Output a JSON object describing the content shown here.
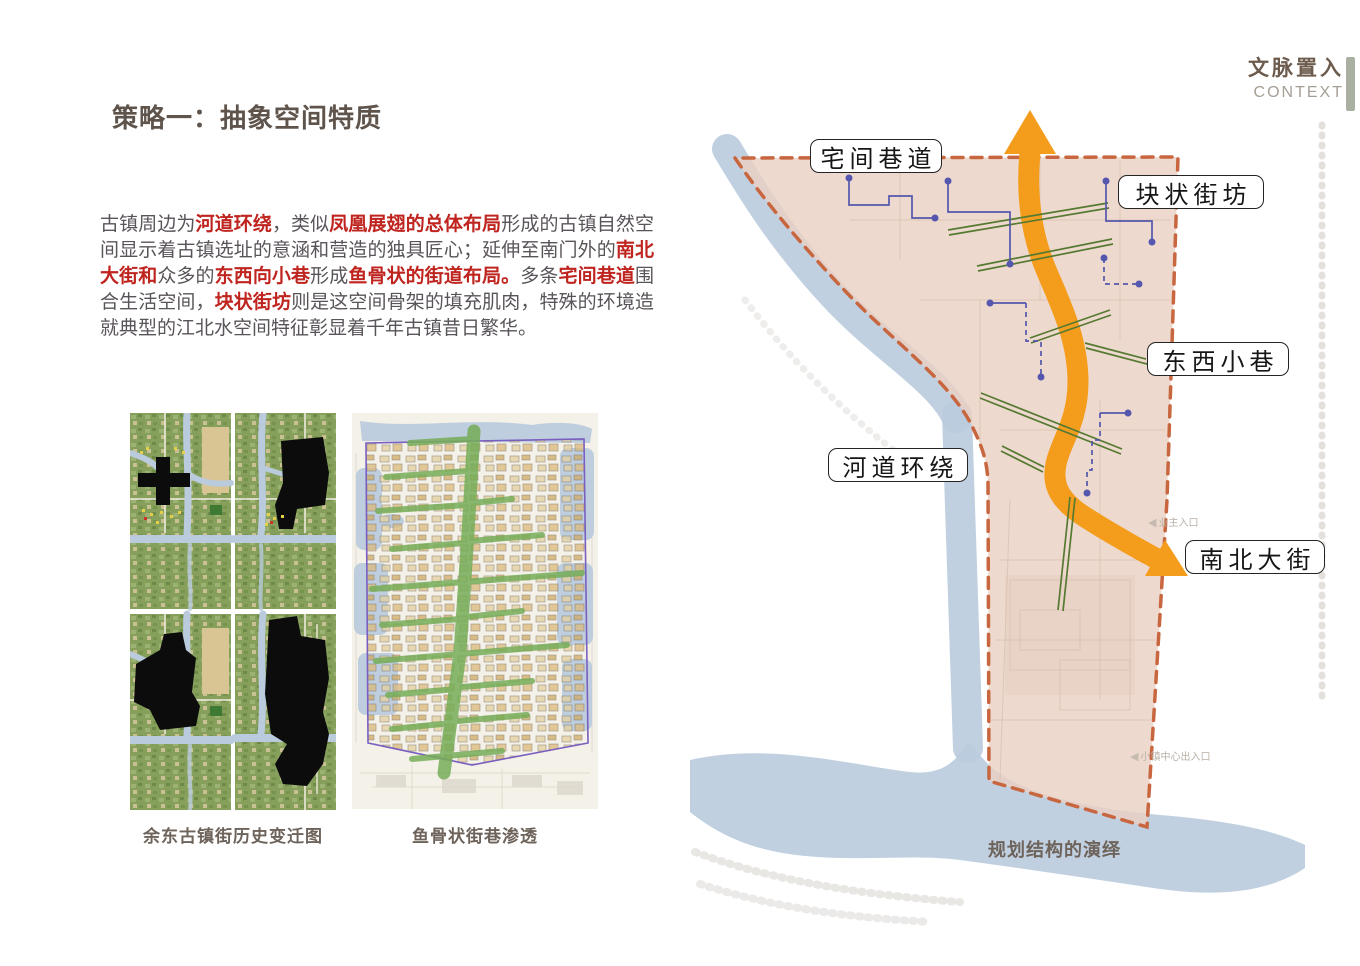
{
  "header": {
    "title_cn": "文脉置入",
    "title_en": "CONTEXT"
  },
  "page_title": "策略一：抽象空间特质",
  "paragraph": {
    "segments": [
      {
        "t": "古镇周边为",
        "h": false
      },
      {
        "t": "河道环绕",
        "h": true
      },
      {
        "t": "，类似",
        "h": false
      },
      {
        "t": "凤凰展翅的总体布局",
        "h": true
      },
      {
        "t": "形成的古镇自然空间显示着古镇选址的意涵和营造的独具匠心；延伸至南门外的",
        "h": false
      },
      {
        "t": "南北大街和",
        "h": true
      },
      {
        "t": "众多的",
        "h": false
      },
      {
        "t": "东西向小巷",
        "h": true
      },
      {
        "t": "形成",
        "h": false
      },
      {
        "t": "鱼骨状的街道布局。",
        "h": true
      },
      {
        "t": "多条",
        "h": false
      },
      {
        "t": "宅间巷道",
        "h": true
      },
      {
        "t": "围合生活空间，",
        "h": false
      },
      {
        "t": "块状街坊",
        "h": true
      },
      {
        "t": "则是这空间骨架的填充肌肉，特殊的环境造就典型的江北水空间特征彰显着千年古镇昔日繁华。",
        "h": false
      }
    ]
  },
  "figures": {
    "history_caption": "余东古镇街历史变迁图",
    "fishbone_caption": "鱼骨状街巷渗透"
  },
  "diagram": {
    "labels": [
      {
        "text": "宅间巷道"
      },
      {
        "text": "块状街坊"
      },
      {
        "text": "东西小巷"
      },
      {
        "text": "河道环绕"
      },
      {
        "text": "南北大街"
      }
    ],
    "faint_labels": [
      {
        "text": "业主入口"
      },
      {
        "text": "小镇中心出入口"
      }
    ],
    "caption": "规划结构的演绎"
  },
  "colors": {
    "accent-red": "#bf241f",
    "arrow-orange": "#f49c1b",
    "river-blue": "#b9cbdd",
    "area-pink": "#ead1c3",
    "area-border": "#c8663f",
    "street-green": "#567a31",
    "path-indigo": "#5457ad",
    "title-brown": "#5f544c",
    "text-gray": "#595459",
    "caption-brown": "#6e635a",
    "bar-sage": "#a9b0a2"
  }
}
